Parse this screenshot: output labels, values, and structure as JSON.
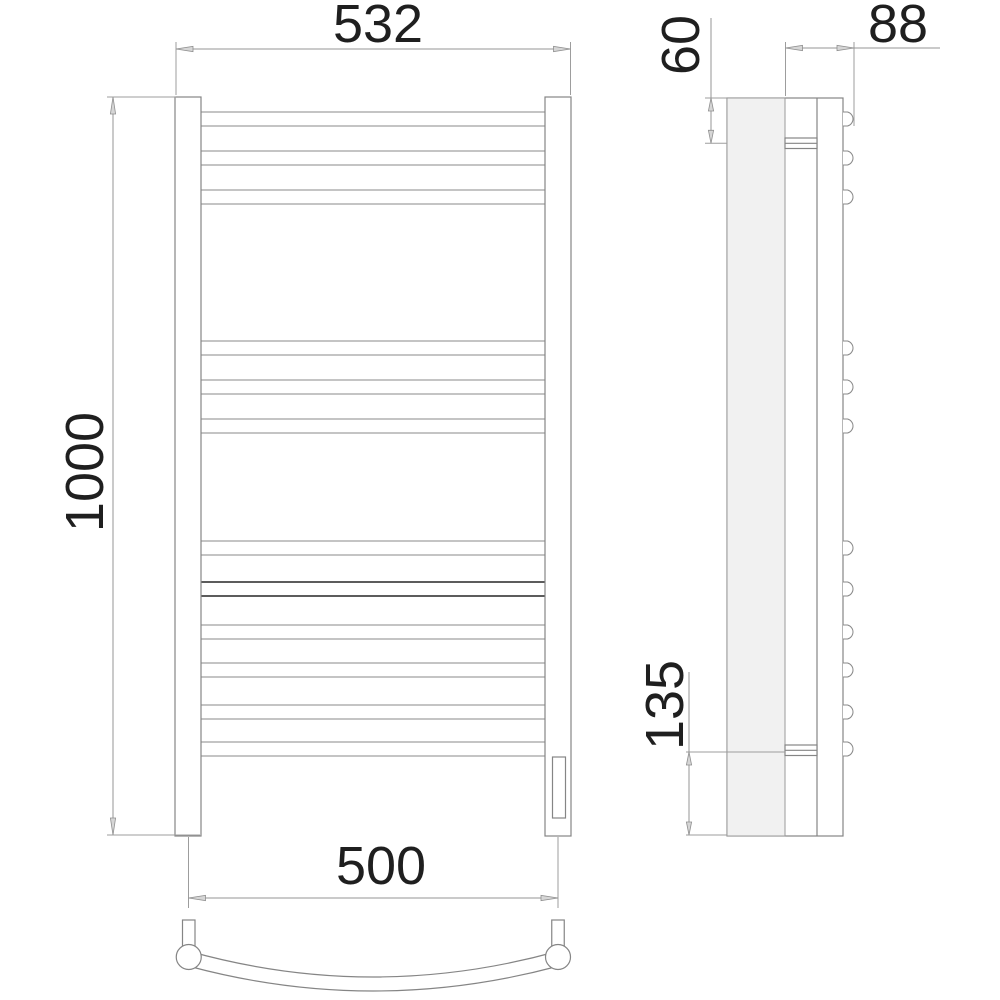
{
  "drawing": {
    "kind": "heated-towel-rail-technical-drawing",
    "background": "#ffffff",
    "line_color": "#8a8a8a",
    "text_color": "#1f1f1f",
    "wall_plate_fill": "#f1f1f1"
  },
  "dimensions": {
    "top_width": "532",
    "overall_height": "1000",
    "bottom_rail_width": "500",
    "depth": "88",
    "top_bracket_offset": "60",
    "bottom_bracket_offset": "135"
  },
  "front_view": {
    "rung_count": 12,
    "rung_tops": [
      112,
      151,
      190,
      341,
      380,
      419,
      541,
      582,
      625,
      663,
      705,
      742
    ],
    "rung_height": 14,
    "rung_left": 201,
    "rung_width": 344,
    "bold_rung_index": 7
  },
  "side_view": {
    "bump_centers": [
      119,
      158,
      197,
      348,
      387,
      426,
      548,
      589,
      632,
      670,
      712,
      749
    ],
    "bump_radius": 7.2
  }
}
